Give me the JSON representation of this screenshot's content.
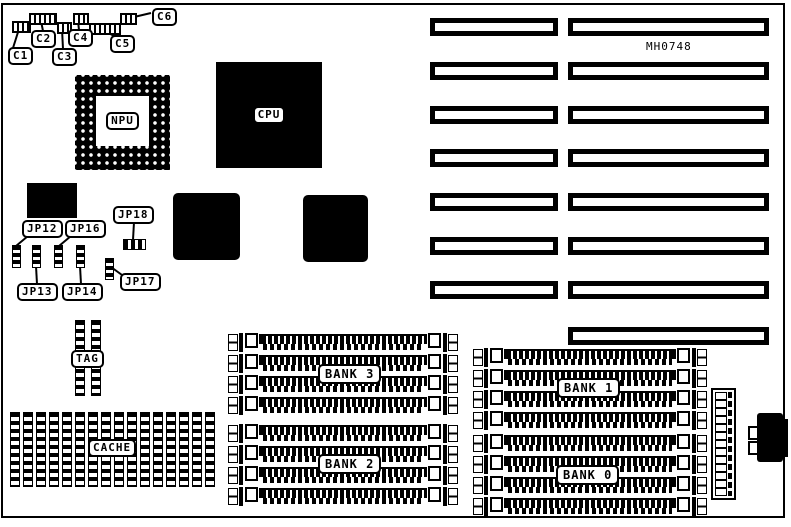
{
  "board": {
    "part_number": "MH0748",
    "processors": {
      "cpu": "CPU",
      "npu": "NPU"
    },
    "capacitors": {
      "c1": "C1",
      "c2": "C2",
      "c3": "C3",
      "c4": "C4",
      "c5": "C5",
      "c6": "C6"
    },
    "jumpers": {
      "jp12": "JP12",
      "jp13": "JP13",
      "jp14": "JP14",
      "jp16": "JP16",
      "jp17": "JP17",
      "jp18": "JP18"
    },
    "memory": {
      "bank0": "BANK 0",
      "bank1": "BANK 1",
      "bank2": "BANK 2",
      "bank3": "BANK 3",
      "cache": "CACHE",
      "tag": "TAG",
      "simm_sockets_per_bank": 4,
      "cache_chip_count": 8
    },
    "expansion": {
      "slot_pair_count": 7,
      "right_only_slot_count": 1
    },
    "colors": {
      "ink": "#000000",
      "paper": "#ffffff"
    }
  }
}
